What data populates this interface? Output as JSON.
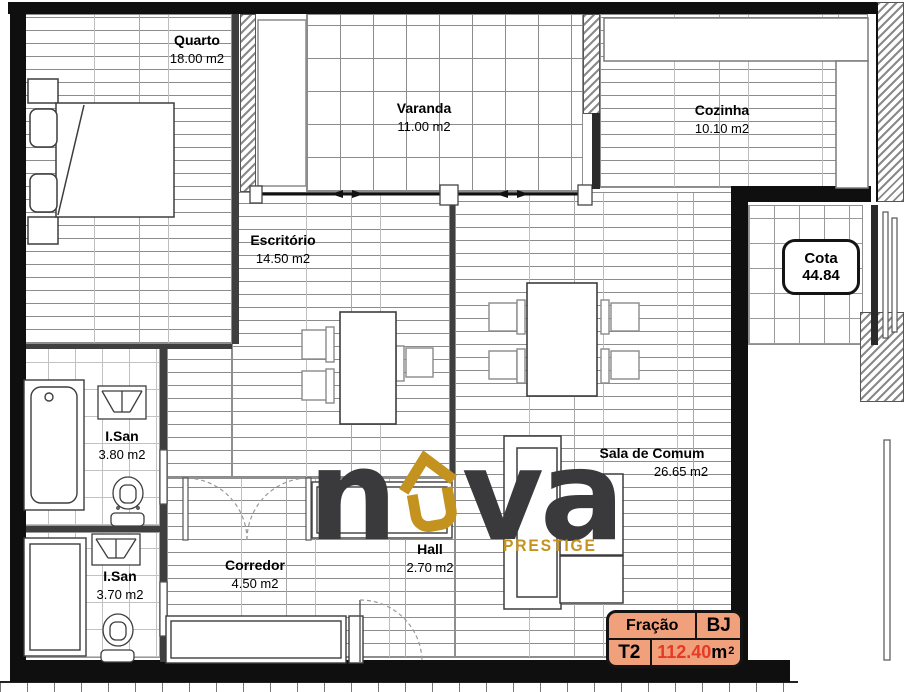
{
  "plan": {
    "rooms": [
      {
        "name": "Quarto",
        "area": "18.00 m2"
      },
      {
        "name": "Varanda",
        "area": "11.00 m2"
      },
      {
        "name": "Cozinha",
        "area": "10.10 m2"
      },
      {
        "name": "Escritório",
        "area": "14.50 m2"
      },
      {
        "name": "I.San",
        "area": "3.80 m2"
      },
      {
        "name": "I.San",
        "area": "3.70 m2"
      },
      {
        "name": "Corredor",
        "area": "4.50 m2"
      },
      {
        "name": "Hall",
        "area": "2.70 m2"
      },
      {
        "name": "Sala de Comum",
        "area": "26.65 m2"
      }
    ],
    "cota": {
      "label": "Cota",
      "value": "44.84"
    },
    "legend": {
      "fraction_label": "Fração",
      "fraction_value": "BJ",
      "typology": "T2",
      "area_value": "112.40",
      "area_unit": "m",
      "area_exponent": "2"
    },
    "brand": {
      "left": "n",
      "right": "va",
      "tagline": "PRESTIGE"
    },
    "colors": {
      "brand_dark": "#3A3A3C",
      "brand_gold": "#C4921F",
      "legend_bg": "#F1A07C",
      "legend_red": "#E63A25",
      "wall_black": "#0F0F0F"
    }
  }
}
